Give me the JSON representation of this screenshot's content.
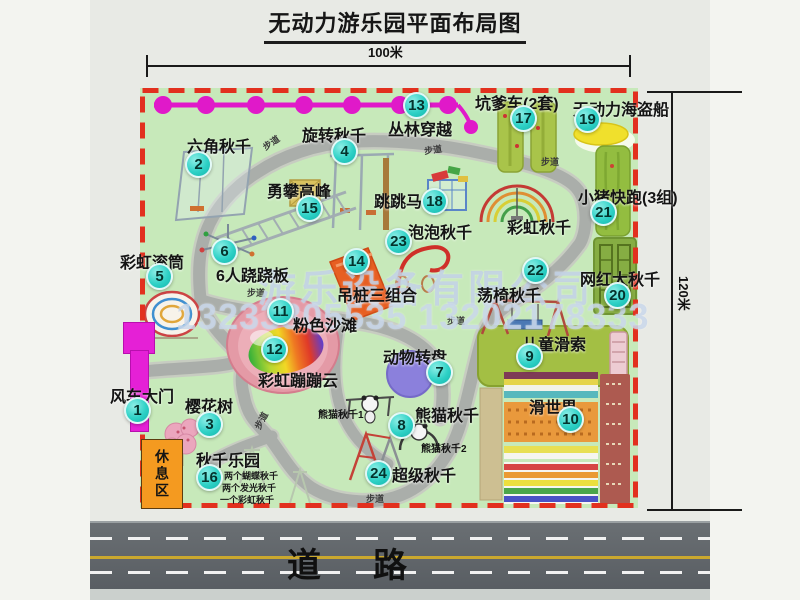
{
  "title": "无动力游乐园平面布局图",
  "dimensions": {
    "width_label": "100米",
    "height_label": "120米"
  },
  "road": {
    "label": "道路"
  },
  "watermark": {
    "company": "游乐设备有限公司",
    "phone": "13233805535 13202178333"
  },
  "labels": {
    "path": "步道",
    "rest_area": "休息区",
    "rainbow_swing": "彩虹秋千",
    "panda_swing_1": "熊猫秋千1",
    "panda_swing_2": "熊猫秋千2"
  },
  "swing_park_notes": [
    "两个蝴蝶秋千",
    "两个发光秋千",
    "一个彩虹秋千"
  ],
  "colors": {
    "park_green": "#c7e9ba",
    "border_red": "#e2301e",
    "badge_teal": "#2ed1c6",
    "zipline_magenta": "#e019c9",
    "gate_magenta": "#e520d6",
    "rest_orange": "#f49a20",
    "road_gray": "#5d6266",
    "road_yellow": "#caa82e"
  },
  "attractions": [
    {
      "num": "1",
      "name": "风车大门"
    },
    {
      "num": "2",
      "name": "六角秋千"
    },
    {
      "num": "3",
      "name": "樱花树"
    },
    {
      "num": "4",
      "name": "旋转秋千"
    },
    {
      "num": "5",
      "name": "彩虹滚筒"
    },
    {
      "num": "6",
      "name": "6人跷跷板"
    },
    {
      "num": "7",
      "name": "动物转盘"
    },
    {
      "num": "8",
      "name": "熊猫秋千"
    },
    {
      "num": "9",
      "name": "儿童滑索"
    },
    {
      "num": "10",
      "name": "滑世界"
    },
    {
      "num": "11",
      "name": "粉色沙滩"
    },
    {
      "num": "12",
      "name": "彩虹蹦蹦云"
    },
    {
      "num": "13",
      "name": "丛林穿越"
    },
    {
      "num": "14",
      "name": "吊桩三组合"
    },
    {
      "num": "15",
      "name": "勇攀高峰"
    },
    {
      "num": "16",
      "name": "秋千乐园"
    },
    {
      "num": "17",
      "name": "坑爹车(2套)"
    },
    {
      "num": "18",
      "name": "跳跳马"
    },
    {
      "num": "19",
      "name": "无动力海盗船"
    },
    {
      "num": "20",
      "name": "网红大秋千"
    },
    {
      "num": "21",
      "name": "小猪快跑(3组)"
    },
    {
      "num": "22",
      "name": "荡椅秋千"
    },
    {
      "num": "23",
      "name": "泡泡秋千"
    },
    {
      "num": "24",
      "name": "超级秋千"
    }
  ]
}
